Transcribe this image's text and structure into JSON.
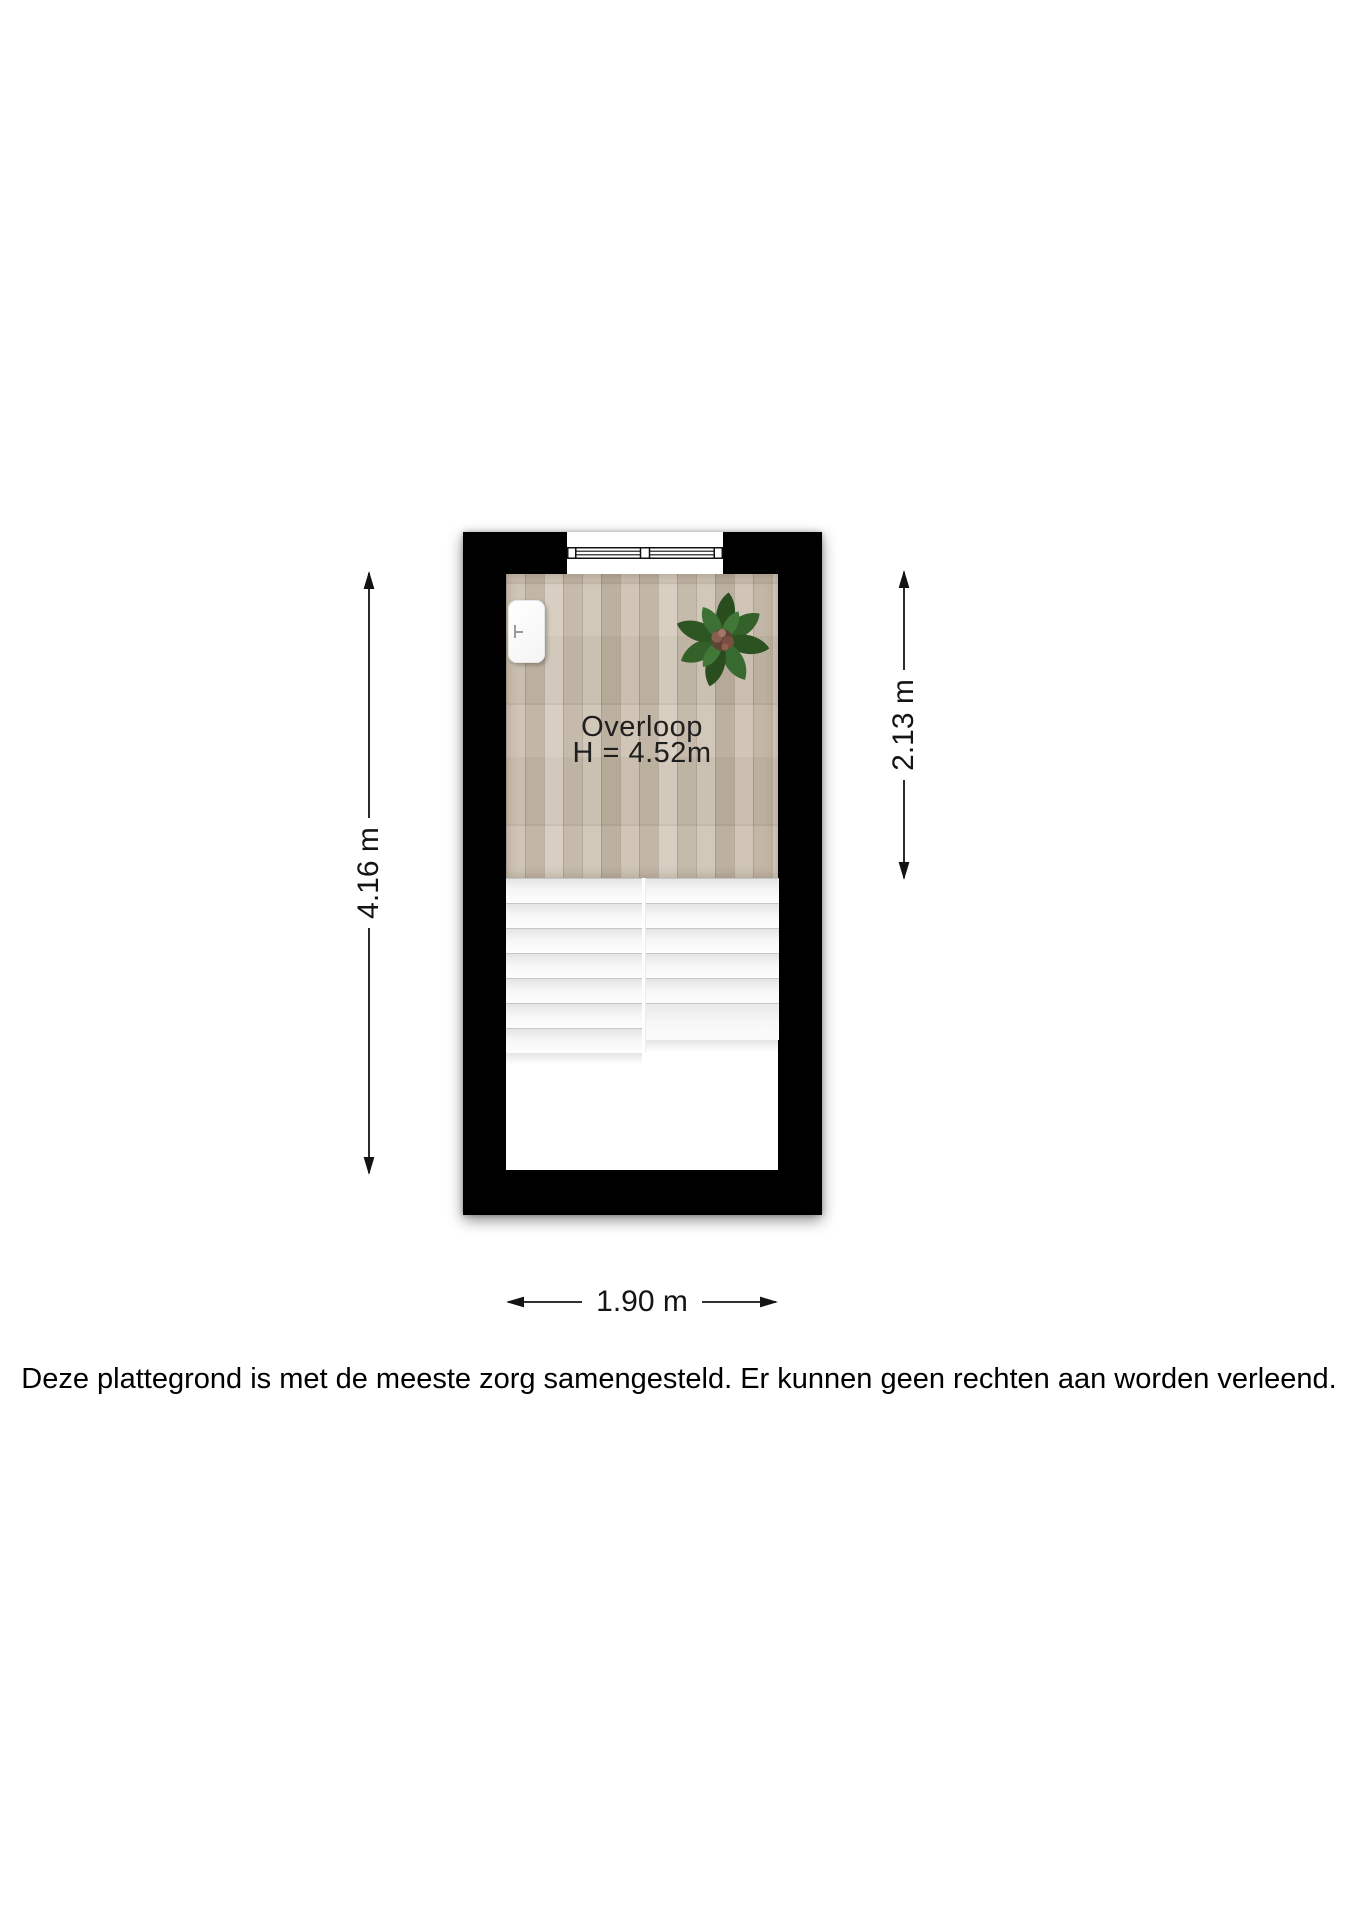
{
  "plan": {
    "room": {
      "name": "Overloop",
      "height_label": "H = 4.52m"
    },
    "dimensions": {
      "total_height": "4.16 m",
      "room_depth": "2.13 m",
      "total_width": "1.90 m"
    },
    "stairs": {
      "left_flight": {
        "treads": 7,
        "tread_height": 25
      },
      "right_flight": {
        "treads": 5,
        "tread_height": 25,
        "landing_height": 37
      }
    },
    "icons": {
      "plant": "potted-plant-top-view",
      "radiator": "radiator-top-view",
      "window": "double-casement-window-symbol"
    },
    "colors": {
      "wall": "#000000",
      "background": "#ffffff",
      "wood_base": "#c8bcab",
      "stair_tread": "#f6f6f6",
      "leaf_green": "#35602a",
      "text": "#1c1c1c"
    }
  },
  "disclaimer": "Deze plattegrond is met de meeste zorg samengesteld. Er kunnen geen rechten aan worden verleend."
}
